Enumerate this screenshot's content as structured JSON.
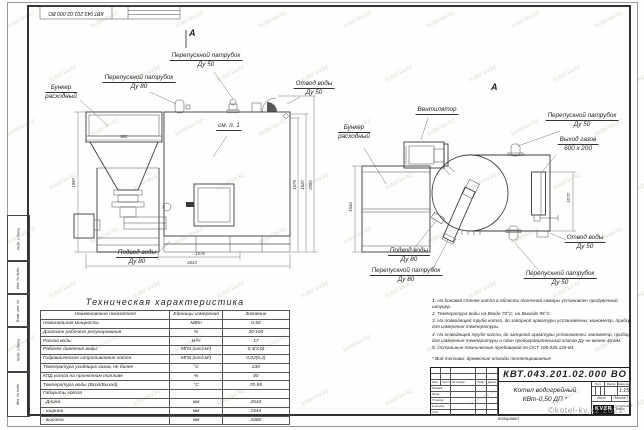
{
  "watermark": {
    "tile": "kotel-kv.kz",
    "stamp": "©kotel-kv.kz 2021"
  },
  "corner_stamp": {
    "designation": "КВТ.043.201.02.000  ВО"
  },
  "views": {
    "front": {
      "section_mark": "А",
      "see_note": "см. п. 1",
      "labels": {
        "bunker1": "Бункер",
        "bunker2": "расходный",
        "bypass80_1": "Перепускной патрубок",
        "bypass80_2": "Ду 80",
        "bypass50_1": "Перепускной патрубок",
        "bypass50_2": "Ду 50",
        "outlet1": "Отвод воды",
        "outlet2": "Ду 50",
        "inlet1": "Подвод воды",
        "inlet2": "Ду 80"
      },
      "dims": {
        "bunker_w": "902",
        "bunker_h": "1960",
        "h1": "1875",
        "h2": "1920",
        "h3": "2080",
        "w1": "1078",
        "w_total": "2643"
      }
    },
    "side": {
      "view_mark": "А",
      "labels": {
        "fan": "Вентилятор",
        "bunker1": "Бункер",
        "bunker2": "расходный",
        "bypass50_top1": "Перепускной патрубок",
        "bypass50_top2": "Ду 50",
        "gas1": "Выход газов",
        "gas2": "600 x 200",
        "outlet1": "Отвод воды",
        "outlet2": "Ду 50",
        "bypass50_bot1": "Перепускной патрубок",
        "bypass50_bot2": "Ду 50",
        "bypass80_1": "Перепускной патрубок",
        "bypass80_2": "Ду 80",
        "inlet1": "Подвод воды",
        "inlet2": "Ду 80"
      },
      "dims": {
        "bunker_h": "1544",
        "gas_h": "1070"
      }
    }
  },
  "spec_table": {
    "title": "Техническая характеристика",
    "headers": [
      "Наименование показателя",
      "Единицы измерения",
      "Значение"
    ],
    "rows": [
      [
        "Номинальная мощность",
        "МВт",
        "0,50"
      ],
      [
        "Диапазон рабочего регулирования",
        "%",
        "30-100"
      ],
      [
        "Расход воды",
        "м³/ч",
        "17"
      ],
      [
        "Рабочее давление воды",
        "МПа (кгс/см²)",
        "0,3(3,0)"
      ],
      [
        "Гидравлическое сопротивление котла",
        "МПа (кгс/см²)",
        "0,02(0,2)"
      ],
      [
        "Температура уходящих газов, не более",
        "°С",
        "230"
      ],
      [
        "КПД котла на проектном топливе",
        "%",
        "80"
      ],
      [
        "Температура воды (Вход/Выход)",
        "°С",
        "70-95"
      ],
      [
        "Габариты котла",
        "",
        ""
      ],
      [
        "    - Длина",
        "мм",
        "2643"
      ],
      [
        "    - ширина",
        "мм",
        "1544"
      ],
      [
        "    - высота",
        "мм",
        "2080"
      ]
    ]
  },
  "notes": {
    "items": [
      "1.  На боковой стенке котла в области топочной камеры установлен продувочный штуцер.",
      "2.  Температура воды на Входе 70°С, на Выходе 95°С.",
      "3.  На подводящей трубе котла, до запорной арматуры установлены: манометр, прибор для измерения температуры.",
      "4.  На отводящей трубе котла, до запорной арматуры установлены: манометр, прибор для измерения температуры и один предохранительный клапан Ду не менее 40 мм.",
      "5.  Остальные технические требования по ОСТ 108.030.133-84."
    ],
    "fuel": "*  Вид топлива:  древесные отходы пеллетированные"
  },
  "title_block": {
    "designation": "КВТ.043.201.02.000  ВО",
    "name_line1": "Котел водогрейный",
    "name_line2": "КВт-0,50  ДП *",
    "header_cols": [
      "Изм.",
      "Лист",
      "№ докум.",
      "Подп.",
      "Дата"
    ],
    "row_labels": [
      "Разраб.",
      "Пров.",
      "Т.контр.",
      "Н.контр.",
      "Утв."
    ],
    "lit_label": "Лит.",
    "mass_label": "Масса",
    "scale_label": "Масштаб",
    "scale_value": "1:15",
    "sheet_label": "Лист",
    "sheets_label": "Листов 1",
    "logo": "KVZR",
    "logo_sub1": "КОТЕЛЬНЫЙ",
    "logo_sub2": "ЗАВОД",
    "copied": "Копировал"
  },
  "margin_stamps": [
    "Подп. и дата",
    "Инв. № дубл.",
    "Взам. инв. №",
    "Подп. и дата",
    "Инв. № подл."
  ]
}
